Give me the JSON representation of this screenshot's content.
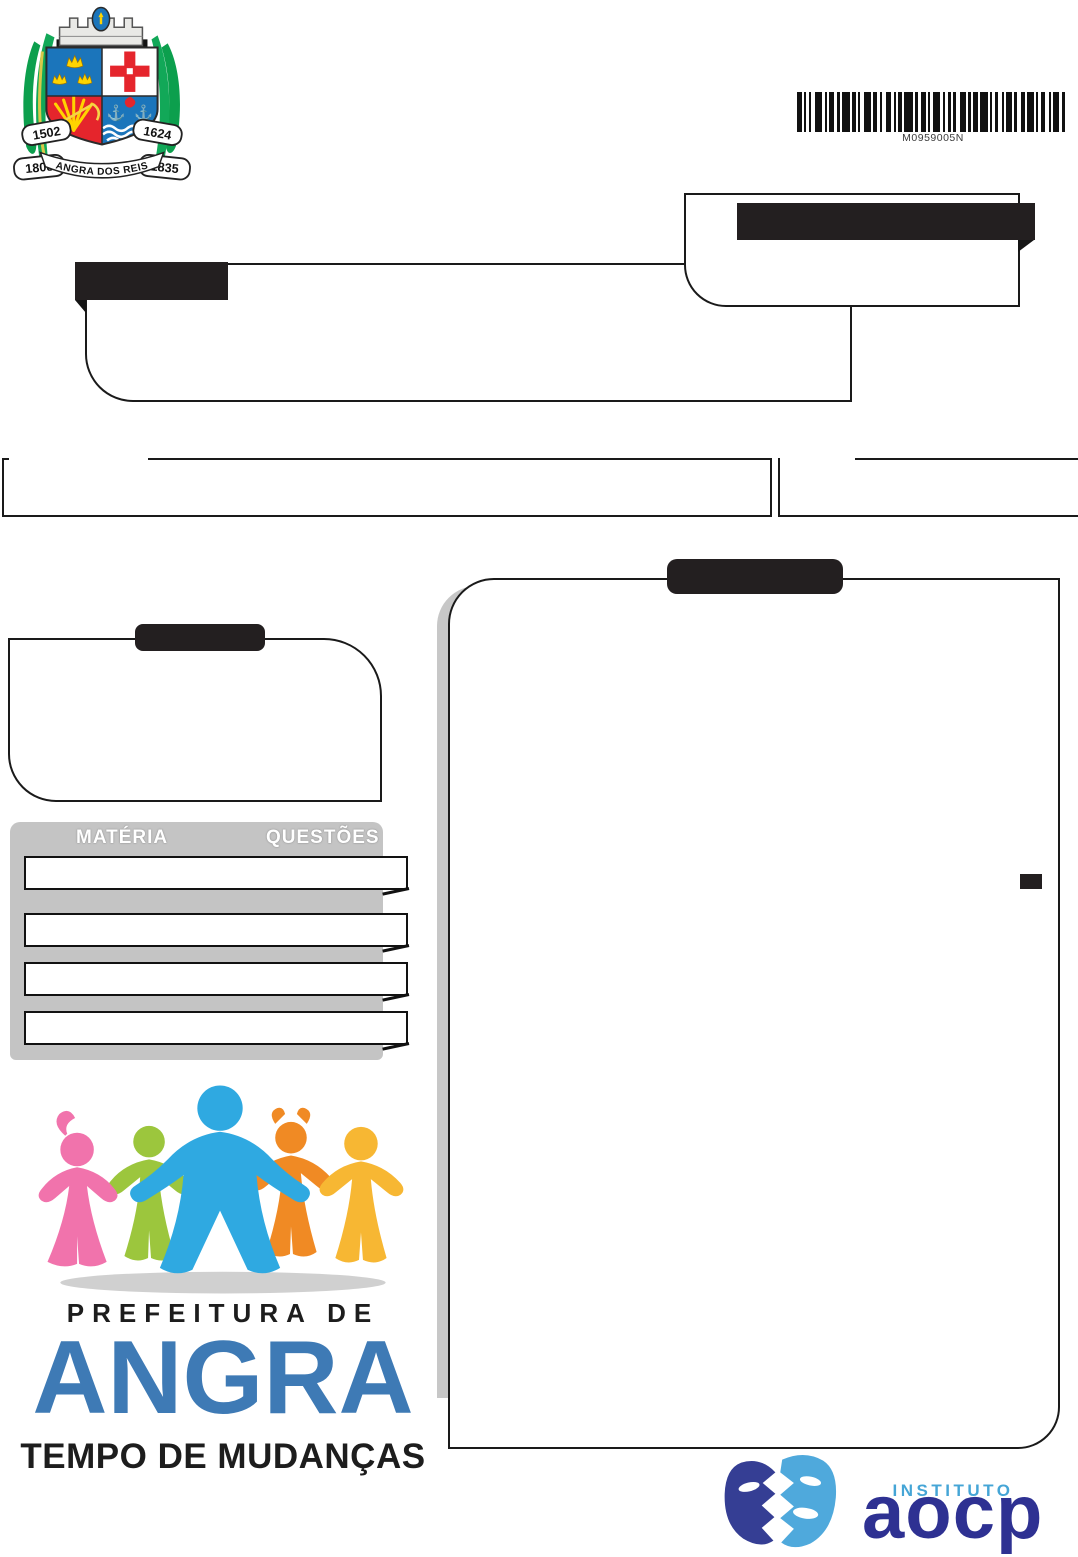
{
  "page": {
    "width": 1078,
    "height": 1557,
    "background": "#ffffff"
  },
  "coat_of_arms": {
    "title": "Brasão de Angra dos Reis",
    "banner": "ANGRA DOS REIS",
    "years": {
      "top_left": "1502",
      "top_right": "1624",
      "bottom_left": "1808",
      "bottom_right": "1835"
    }
  },
  "barcode": {
    "text": "M0959005N",
    "bars": [
      4,
      2,
      2,
      2,
      2,
      4,
      6,
      2,
      2,
      2,
      4,
      3,
      2,
      2,
      7,
      2,
      3,
      2,
      2,
      3,
      6,
      2,
      4,
      2,
      2,
      3,
      5,
      2,
      2,
      2,
      3,
      2,
      8,
      2,
      2,
      3,
      4,
      2,
      2,
      2,
      6,
      3,
      2,
      2,
      3,
      2,
      2,
      4,
      5,
      2,
      2,
      2,
      4,
      2,
      7,
      2,
      2,
      2,
      3,
      3,
      2,
      2,
      5,
      2,
      2,
      4,
      3,
      2,
      6,
      2,
      2,
      2,
      4,
      3,
      2,
      2,
      5,
      2,
      3,
      2
    ]
  },
  "redactions": {
    "tab_a": "",
    "bar_b": "",
    "tab_c": "",
    "tab_d": "",
    "mini": "",
    "color": "#231f20"
  },
  "subjects_table": {
    "header": {
      "materia": "MATÉRIA",
      "questoes": "QUESTÕES"
    },
    "header_bg": "#c4c4c4",
    "rows": [
      {
        "materia": "",
        "questoes": ""
      },
      {
        "materia": "",
        "questoes": ""
      },
      {
        "materia": "",
        "questoes": ""
      },
      {
        "materia": "",
        "questoes": ""
      }
    ]
  },
  "city_logo": {
    "line1": "PREFEITURA DE",
    "line2": "ANGRA",
    "line3": "TEMPO DE MUDANÇAS",
    "angra_color": "#3e7ab5"
  },
  "aocp_logo": {
    "institute": "INSTITUTO",
    "name": "aocp",
    "institute_color": "#45a5d6",
    "name_color": "#2e3192"
  }
}
